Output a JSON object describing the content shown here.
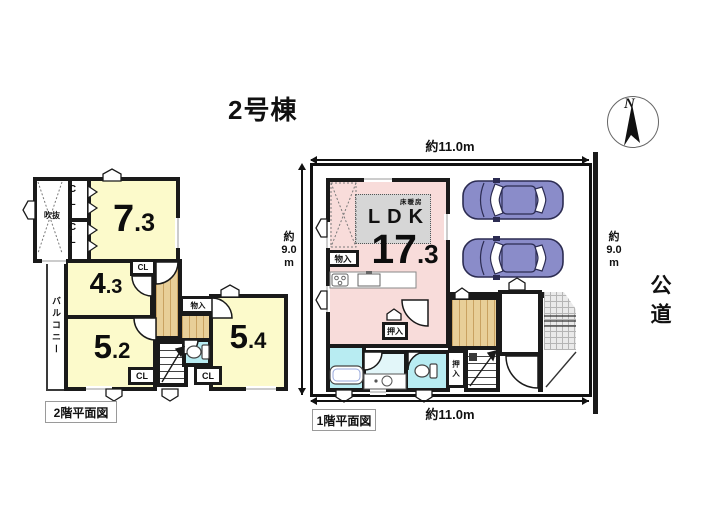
{
  "title": "2号棟",
  "compass": {
    "n": "N"
  },
  "shared": {
    "cl": "CL"
  },
  "plan2f": {
    "label": "2階平面図",
    "void": "吹抜",
    "balcony": "バルコニー",
    "storage": "物入",
    "rooms": {
      "r73": {
        "int": "7",
        "dec": ".3"
      },
      "r43": {
        "int": "4",
        "dec": ".3"
      },
      "r52": {
        "int": "5",
        "dec": ".2"
      },
      "r54": {
        "int": "5",
        "dec": ".4"
      }
    }
  },
  "plan1f": {
    "label": "1階平面図",
    "ldk": {
      "name": "LDK",
      "int": "17",
      "dec": ".3"
    },
    "floor_heating": "床暖房",
    "storage": "物入",
    "oshiire": "押入",
    "road": "公道",
    "dims": {
      "top": "約11.0m",
      "bottom": "約11.0m",
      "left": [
        "約",
        "9.0",
        "m"
      ],
      "right": [
        "約",
        "9.0",
        "m"
      ]
    }
  }
}
